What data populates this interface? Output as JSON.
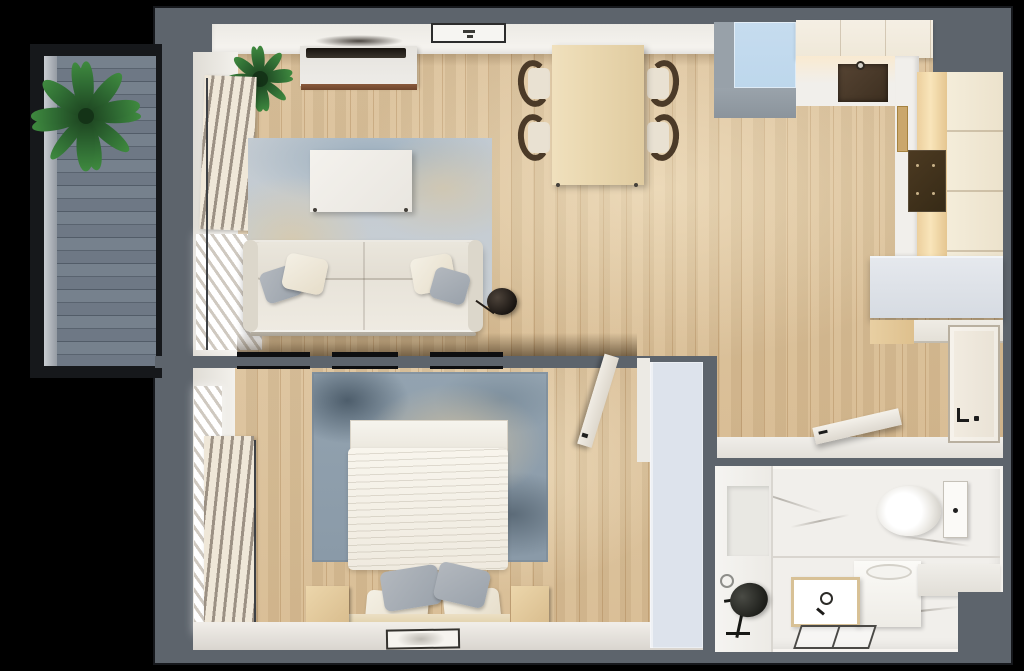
{
  "title": "apartment-floor-plan-3d-top-view",
  "colors": {
    "background": "#000000",
    "wall": "#5d646c",
    "wood": "#dcc29b",
    "deck": "#76818d",
    "deck_line": "#59636f",
    "marble": "#f1efeb",
    "cream": "#efe8d8",
    "blue": "#bdd7ec",
    "island": "#d6dbe2",
    "wardrobe": "#dde3ec",
    "door": "#e9e2d5",
    "sofa": "#efebe2",
    "bed": "#efeadf",
    "rug_living": "#c2cad1",
    "rug_bedroom": "#93a3b0",
    "table": "#ead8b0",
    "chair": "#4b3a28",
    "nightstand": "#d9bd8e",
    "trim": "#8a5a3c",
    "plant_light": "#2f6b33",
    "plant_dark": "#1d4420",
    "pillow_gray": "#9aa2ab",
    "pillow_cream": "#e6ddc9"
  },
  "scene": {
    "rooms": [
      {
        "name": "balcony",
        "items": [
          "potted-plant",
          "wood-deck"
        ]
      },
      {
        "name": "living-room",
        "items": [
          "sofa",
          "throw-pillows",
          "area-rug",
          "coffee-table",
          "tv-console",
          "tv",
          "corner-plant",
          "window-blinds",
          "ceiling-light",
          "decor-sphere"
        ]
      },
      {
        "name": "dining-area",
        "items": [
          "dining-table",
          "chair",
          "chair",
          "chair",
          "chair"
        ]
      },
      {
        "name": "kitchen",
        "items": [
          "blue-cabinet",
          "upper-cabinets",
          "countertop",
          "sink",
          "cooktop",
          "kitchen-island",
          "drawer-unit",
          "entrance-door",
          "bathroom-door-open"
        ]
      },
      {
        "name": "bedroom",
        "items": [
          "double-bed",
          "duvet",
          "pillows",
          "headboard",
          "nightstand",
          "nightstand",
          "area-rug",
          "window-blinds",
          "wardrobe",
          "bedroom-door",
          "floor-picture"
        ]
      },
      {
        "name": "bathroom",
        "items": [
          "toilet",
          "washing-machine",
          "sink-vanity",
          "shower-niche",
          "floor-drain",
          "fan-stool",
          "bench"
        ]
      }
    ]
  }
}
